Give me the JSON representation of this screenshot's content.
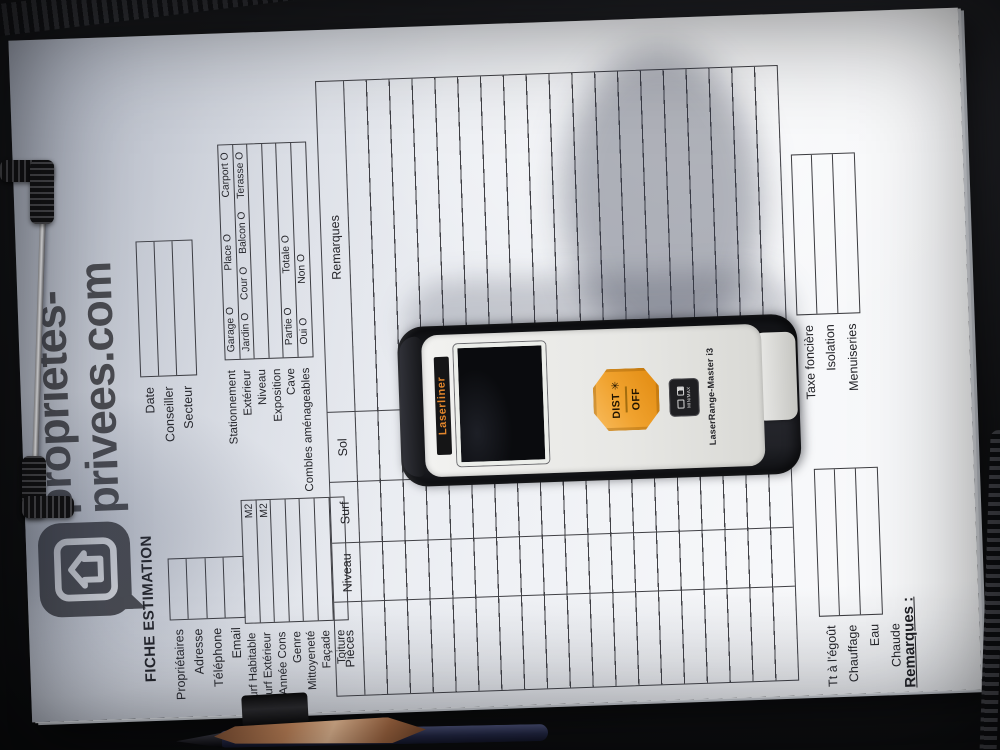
{
  "logo": {
    "line1": "proprietes-",
    "line2": "privees.com"
  },
  "form": {
    "title": "FICHE ESTIMATION",
    "identity_labels": [
      "Propriétaires",
      "Adresse",
      "Téléphone",
      "Email"
    ],
    "meta_labels": [
      "Date",
      "Conseiller",
      "Secteur"
    ],
    "characteristics": [
      {
        "label": "Surf Habitable",
        "unit": "M2"
      },
      {
        "label": "Surf Extérieur",
        "unit": "M2"
      },
      {
        "label": "Année Cons",
        "unit": ""
      },
      {
        "label": "Genre",
        "unit": ""
      },
      {
        "label": "Mittoyeneté",
        "unit": ""
      },
      {
        "label": "Façade",
        "unit": ""
      },
      {
        "label": "Toiture",
        "unit": ""
      }
    ],
    "amenities": [
      {
        "label": "Stationnement",
        "options": [
          "Garage O",
          "Place O",
          "Carport O"
        ]
      },
      {
        "label": "Extérieur",
        "options": [
          "Jardin O",
          "Cour O",
          "Balcon O",
          "Terasse O"
        ]
      },
      {
        "label": "Niveau",
        "options": []
      },
      {
        "label": "Exposition",
        "options": []
      },
      {
        "label": "Cave",
        "options": [
          "Partie O",
          "Totale O"
        ]
      },
      {
        "label": "Combles aménageables",
        "options": [
          "Oui O",
          "Non O"
        ]
      }
    ],
    "rooms_table": {
      "headers": [
        "Pièces",
        "Niveau",
        "Surf",
        "Sol",
        "Remarques"
      ],
      "empty_row_count": 19
    },
    "footer_right_labels": [
      "Taxe foncière",
      "Isolation",
      "Menuiseries"
    ],
    "footer_left_labels": [
      "Tt à l'égoût",
      "Chauffage",
      "Eau Chaude"
    ],
    "remarks_label": "Remarques :"
  },
  "device": {
    "brand": "Laserliner",
    "model": "LaserRange-Master i3",
    "buttons": {
      "dist": "DIST",
      "off": "OFF",
      "minmax": "MIN/MAX"
    }
  },
  "colors": {
    "paper": "#ECEFF4",
    "ink": "#3C3C40",
    "logo_gray": "#4B4B4E",
    "button_orange": "#F0A22E",
    "brand_orange": "#E2862C",
    "leather": "#121316"
  }
}
